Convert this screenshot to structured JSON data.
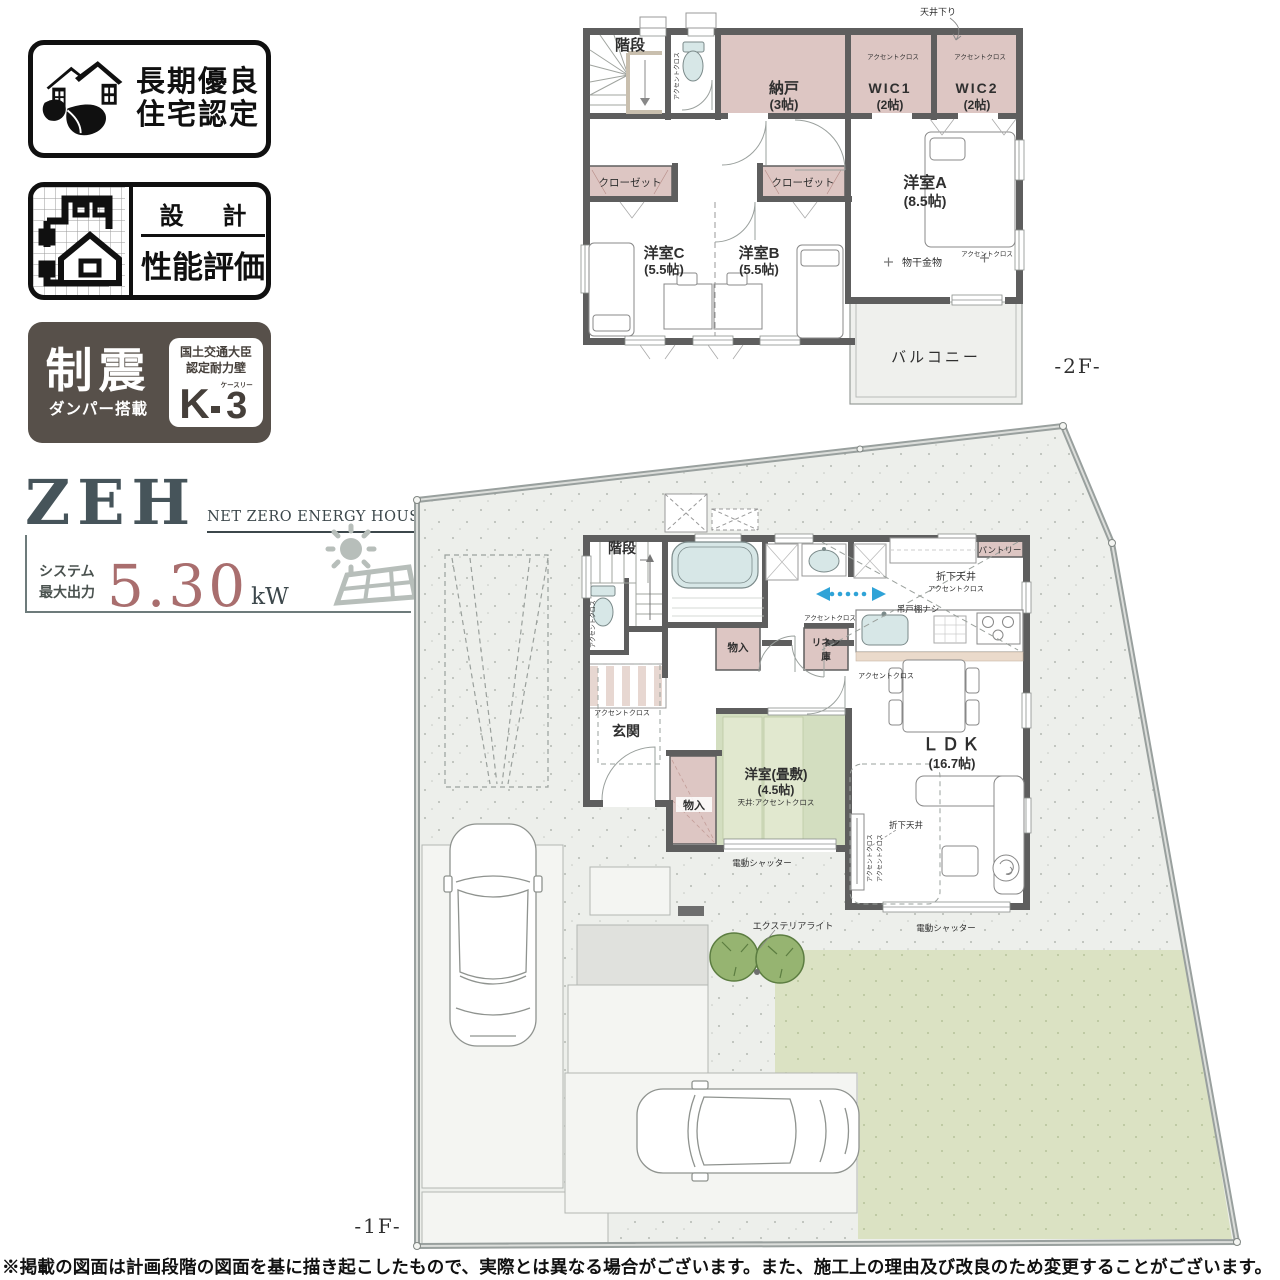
{
  "badges": {
    "longlife": {
      "line1": "長期優良",
      "line2": "住宅認定"
    },
    "design": {
      "top": "設 計",
      "bottom": "性能評価"
    },
    "damper": {
      "main": "制震",
      "sub": "ダンパー搭載",
      "cert1": "国土交通大臣",
      "cert2": "認定耐力壁",
      "k": "K",
      "kana": "ケースリー",
      "three": "3"
    },
    "zeh": {
      "logo": "ZEH",
      "tagline": "NET ZERO ENERGY HOUSE",
      "sys1": "システム",
      "sys2": "最大出力",
      "value": "5.30",
      "unit": "kW"
    }
  },
  "floor2": {
    "floor_label": "-2F-",
    "stairs": "階段",
    "storage": "納戸",
    "storage_size": "(3帖)",
    "wic1": "WIC1",
    "wic1_size": "(2帖)",
    "wic2": "WIC2",
    "wic2_size": "(2帖)",
    "room_a": "洋室A",
    "room_a_size": "(8.5帖)",
    "room_b": "洋室B",
    "room_b_size": "(5.5帖)",
    "room_c": "洋室C",
    "room_c_size": "(5.5帖)",
    "balcony": "バルコニー",
    "closet": "クローゼット",
    "ceiling_drop": "天井下り",
    "accent_cloth": "アクセントクロス",
    "laundry_hook": "物干金物"
  },
  "floor1": {
    "floor_label": "-1F-",
    "stairs": "階段",
    "entrance": "玄関",
    "storage": "物入",
    "linen_top": "リネン",
    "linen_bottom": "庫",
    "pantry": "パントリー",
    "tatami": "洋室(畳敷)",
    "tatami_size": "(4.5帖)",
    "tatami_ceiling": "天井:アクセントクロス",
    "ldk": "ＬＤＫ",
    "ldk_size": "(16.7帖)",
    "accent_cloth": "アクセントクロス",
    "folded_ceiling": "折下天井",
    "no_hanging_cabinet": "吊戸棚ナシ",
    "shutter": "電動シャッター",
    "exterior_light": "エクステリアライト"
  },
  "disclaimer": "※掲載の図面は計画段階の図面を基に描き起こしたもので、実際とは異なる場合がございます。また、施工上の理由及び改良のため変更することがございます。"
}
